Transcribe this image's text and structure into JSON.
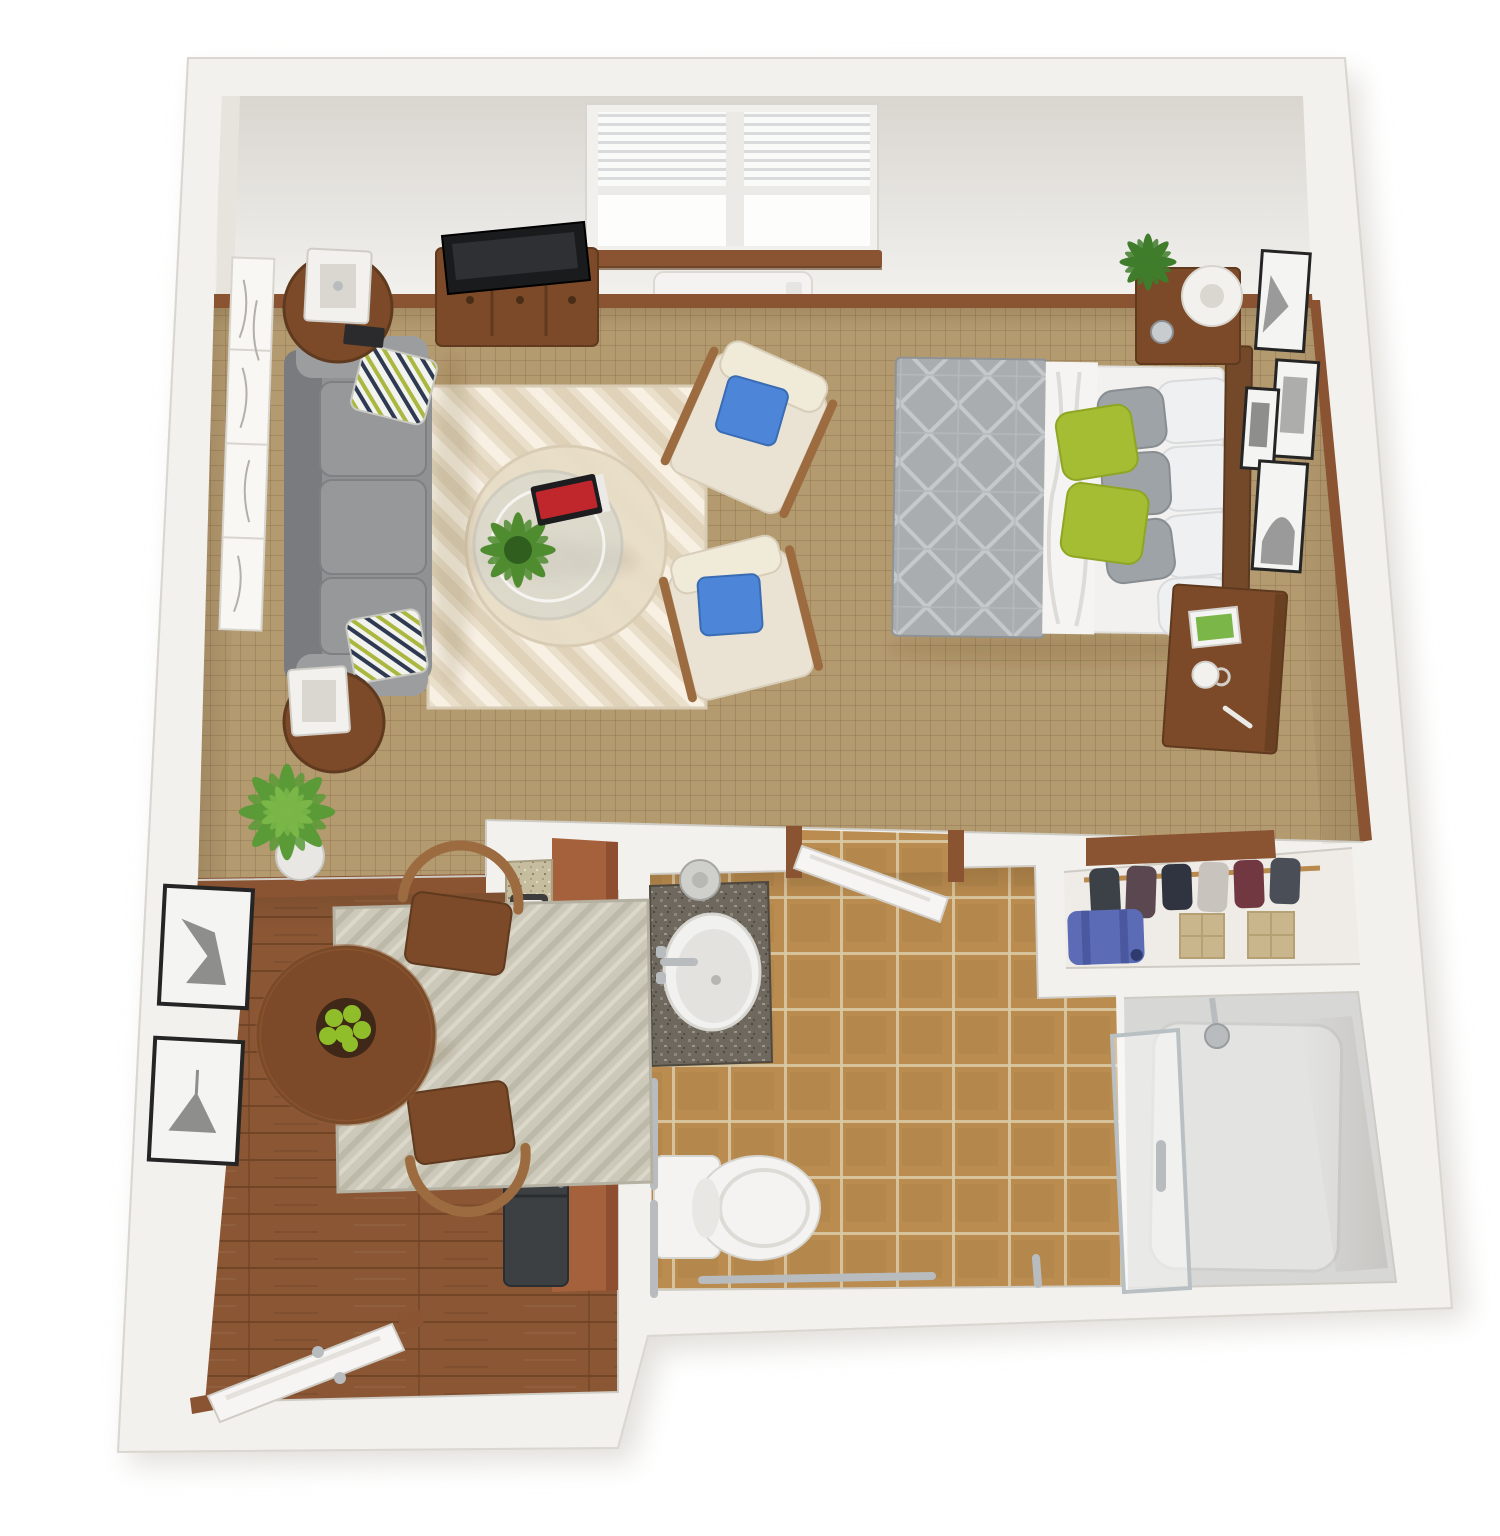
{
  "scene": {
    "kind": "3d-floor-plan-render",
    "subject": "studio apartment",
    "view": "top-down isometric",
    "rooms": {
      "living_area": {
        "name": "living-area",
        "items": [
          "gray-sofa",
          "chevron-area-rug",
          "glass-coffee-table",
          "accent-chair",
          "accent-chair",
          "tv-console",
          "flat-screen-tv",
          "round-side-table",
          "round-side-table",
          "table-lamp",
          "table-lamp",
          "floor-plant",
          "wall-art-panels",
          "window-with-blinds",
          "wall-ac-unit"
        ]
      },
      "bedroom_area": {
        "name": "bedroom-area",
        "items": [
          "bed",
          "gray-duvet",
          "green-accent-pillows",
          "headboard",
          "nightstand",
          "table-lamp",
          "potted-plant",
          "writing-desk",
          "photo-frame",
          "coffee-mug",
          "gallery-wall-frames"
        ]
      },
      "dining_nook": {
        "name": "dining-nook",
        "items": [
          "round-dining-table",
          "dining-chair",
          "dining-chair",
          "area-rug",
          "fruit-bowl",
          "framed-prints",
          "floor-plant"
        ]
      },
      "kitchen": {
        "name": "kitchen",
        "items": [
          "brown-cabinet-run",
          "granite-counter",
          "kitchen-sink",
          "range",
          "refrigerator"
        ]
      },
      "bathroom": {
        "name": "bathroom",
        "items": [
          "granite-vanity",
          "oval-sink",
          "faucet",
          "toilet",
          "grab-bars",
          "open-door",
          "tile-floor"
        ]
      },
      "closet": {
        "name": "closet",
        "items": [
          "clothes-rod",
          "hanging-clothes",
          "suitcase",
          "storage-box",
          "storage-box",
          "shelf"
        ]
      },
      "shower": {
        "name": "shower",
        "items": [
          "glass-sliding-door",
          "shower-head",
          "shower-pan"
        ]
      },
      "entry": {
        "name": "entry",
        "items": [
          "entry-door",
          "door-handle",
          "wood-floor"
        ]
      }
    }
  },
  "colors": {
    "bg": "#ffffff",
    "wall": "#f3f1ee",
    "wall_face": "#e3e0da",
    "wall_edge": "#d5d2cb",
    "carpet": "#b49a6f",
    "carpet_line": "#8f7450",
    "wood": "#8a5634",
    "wood_line": "#6d4124",
    "tile": "#bb8c4f",
    "tile_grout": "#dbc9a3",
    "trim_wood": "#8a5332",
    "rug_living": "#eadfcb",
    "rug_living_stripe": "#f7f0e3",
    "rug_living_stripe2": "#dfd2b9",
    "rug_dining": "#cdc9ba",
    "rug_dining_stripe": "#bcb7a7",
    "sofa": "#8f9193",
    "sofa_dark": "#797b7e",
    "sofa_light": "#9b9d9f",
    "armchair": "#eae3d3",
    "armchair_edge": "#d7cdb8",
    "chair_wood": "#9c6b40",
    "pillow_blue": "#4d86d9",
    "pillow_green": "#a4bd33",
    "pillow_gray": "#9ea3a7",
    "pillow_white": "#eff0f1",
    "bed_sheet": "#f2f1ef",
    "duvet": "#a9adb0",
    "duvet_line": "#c6c9cc",
    "headboard": "#74492a",
    "wood_furniture": "#7c4a28",
    "wood_furniture_dark": "#5f3a1f",
    "tv_black": "#1a1b1d",
    "ac_white": "#f4f3f1",
    "vent_dark": "#2c2e30",
    "granite_dark": "#6e685e",
    "granite_light": "#c6bc9e",
    "sink_white": "#f1f1ef",
    "toilet_white": "#f4f3f1",
    "chrome": "#b9bcbf",
    "shower_floor": "#d7d7d5",
    "tub_inner": "#e3e3e1",
    "glass_frame": "#b9c0c3",
    "suitcase_blue": "#5b6bb5",
    "suitcase_dark": "#4a58a0",
    "box_beige": "#c9b68c",
    "box_edge": "#b5a274",
    "clothes": [
      "#3c4148",
      "#5a4750",
      "#2f3440",
      "#713842",
      "#c8c3bc",
      "#4a4f57"
    ],
    "appliance": "#3c4043",
    "cabinet_brown": "#a5613c",
    "cabinet_brown_dark": "#8d4f30",
    "plant_green": "#5a9b38",
    "plant_green_light": "#7ab648",
    "plant_green_dark": "#3f7d2c",
    "apple_green": "#8fbe2a",
    "bowl_brown": "#3f2817",
    "frame_black": "#252525",
    "frame_mat": "#f4f4f2",
    "art_gray": "#9a9a9a",
    "door_white": "#f6f5f3",
    "book_red": "#c0272d",
    "lamp_white": "#f2f1ee"
  }
}
